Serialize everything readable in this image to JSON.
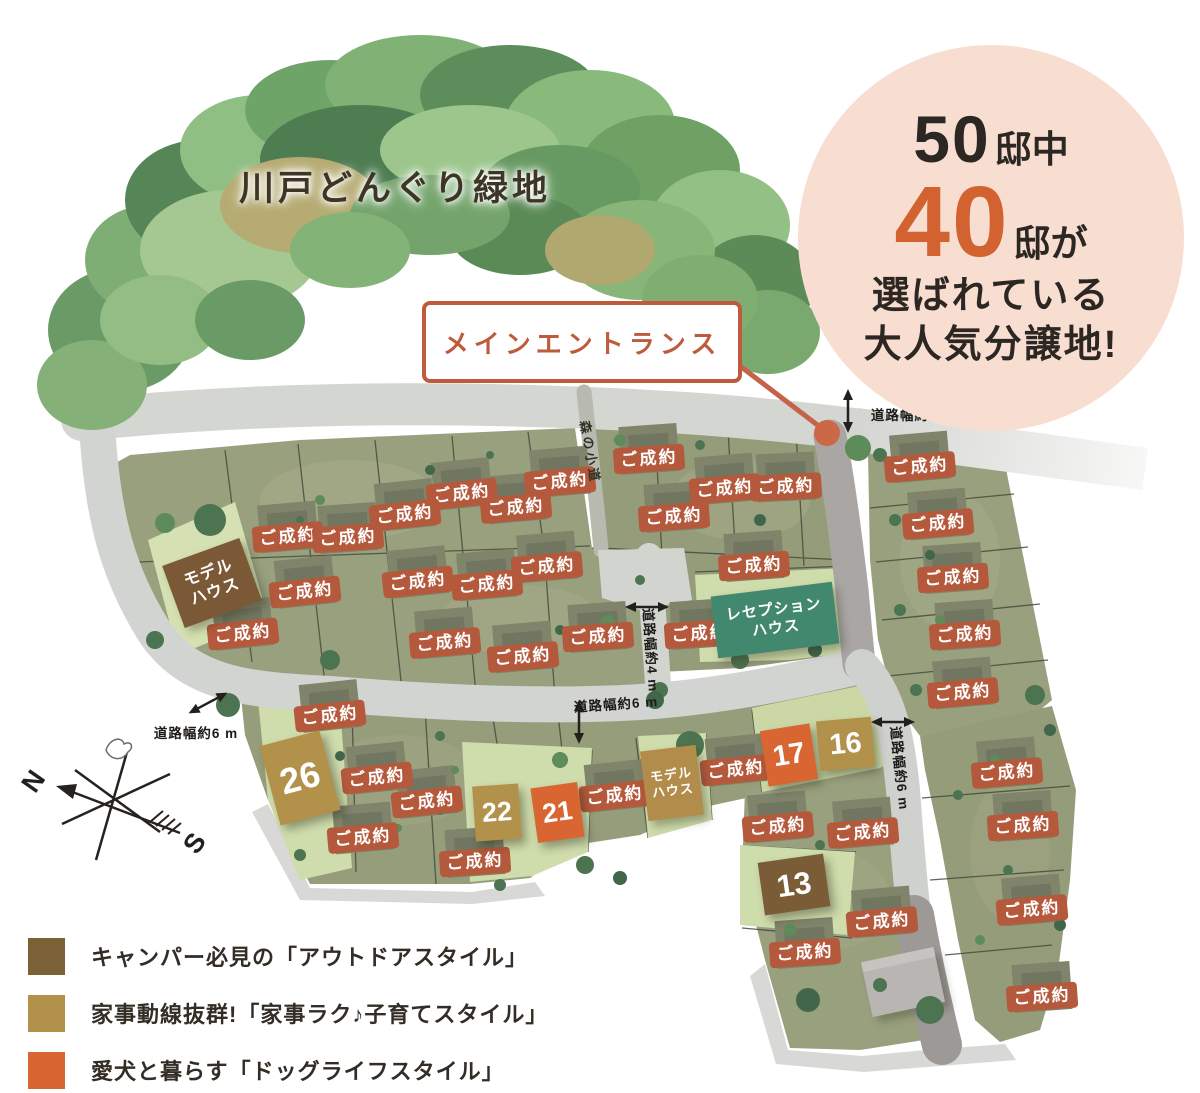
{
  "forest": {
    "title": "川戸どんぐり緑地"
  },
  "badge": {
    "top_num": "50",
    "top_suffix": "邸中",
    "mid_num": "40",
    "mid_suffix": "邸が",
    "line3": "選ばれている",
    "line4": "大人気分譲地!"
  },
  "entrance_label": "メインエントランス",
  "sold_label": "ご成約",
  "sold_lots": [
    [
      649,
      459,
      -4
    ],
    [
      560,
      482,
      -5
    ],
    [
      462,
      494,
      -6
    ],
    [
      725,
      489,
      -5
    ],
    [
      786,
      487,
      -3
    ],
    [
      516,
      508,
      -5
    ],
    [
      674,
      517,
      -4
    ],
    [
      405,
      515,
      -6
    ],
    [
      288,
      537,
      -5
    ],
    [
      348,
      538,
      -4
    ],
    [
      920,
      467,
      -5
    ],
    [
      547,
      567,
      -5
    ],
    [
      754,
      566,
      -4
    ],
    [
      418,
      582,
      -6
    ],
    [
      487,
      585,
      -5
    ],
    [
      305,
      592,
      -6
    ],
    [
      938,
      524,
      -5
    ],
    [
      953,
      578,
      -4
    ],
    [
      243,
      634,
      -6
    ],
    [
      445,
      643,
      -5
    ],
    [
      523,
      657,
      -5
    ],
    [
      598,
      637,
      -4
    ],
    [
      700,
      634,
      -4
    ],
    [
      965,
      635,
      -4
    ],
    [
      963,
      693,
      -5
    ],
    [
      330,
      716,
      -6
    ],
    [
      377,
      778,
      -6
    ],
    [
      427,
      802,
      -6
    ],
    [
      363,
      838,
      -5
    ],
    [
      475,
      862,
      -4
    ],
    [
      615,
      796,
      -6
    ],
    [
      736,
      770,
      -6
    ],
    [
      1007,
      773,
      -5
    ],
    [
      778,
      827,
      -5
    ],
    [
      863,
      833,
      -5
    ],
    [
      1023,
      826,
      -4
    ],
    [
      882,
      922,
      -5
    ],
    [
      805,
      953,
      -4
    ],
    [
      1032,
      910,
      -5
    ],
    [
      1042,
      997,
      -4
    ]
  ],
  "numbered_lots": [
    {
      "num": "26",
      "x": 300,
      "y": 778,
      "w": 62,
      "h": 82,
      "rot": -15,
      "style": "kaji"
    },
    {
      "num": "22",
      "x": 497,
      "y": 812,
      "w": 46,
      "h": 55,
      "rot": -4,
      "style": "kaji"
    },
    {
      "num": "21",
      "x": 557,
      "y": 812,
      "w": 47,
      "h": 55,
      "rot": -8,
      "style": "dog"
    },
    {
      "num": "17",
      "x": 789,
      "y": 755,
      "w": 50,
      "h": 56,
      "rot": -9,
      "style": "dog"
    },
    {
      "num": "16",
      "x": 845,
      "y": 744,
      "w": 55,
      "h": 50,
      "rot": -5,
      "style": "kaji"
    },
    {
      "num": "13",
      "x": 794,
      "y": 884,
      "w": 66,
      "h": 53,
      "rot": -8,
      "style": "outdoor"
    }
  ],
  "style_colors": {
    "outdoor": "#7a5c36",
    "kaji": "#b2914b",
    "dog": "#d96632"
  },
  "buildings": [
    {
      "id": "model-house-left",
      "line1": "モデル",
      "line2": "ハウス",
      "x": 212,
      "y": 583,
      "w": 82,
      "h": 66,
      "rot": -20,
      "bg": "#7b5836",
      "font": 16
    },
    {
      "id": "model-house-bottom",
      "line1": "モデル",
      "line2": "ハウス",
      "x": 672,
      "y": 783,
      "w": 56,
      "h": 70,
      "rot": -7,
      "bg": "#b28c4a",
      "font": 13
    },
    {
      "id": "reception-house",
      "line1": "レセプション",
      "line2": "ハウス",
      "x": 775,
      "y": 620,
      "w": 122,
      "h": 62,
      "rot": -7,
      "bg": "#41886f",
      "font": 15
    }
  ],
  "road_labels": [
    {
      "text": "道路幅約6 m",
      "x": 913,
      "y": 414,
      "rot": 0,
      "arrow": "v",
      "ax": 848,
      "ay": 411
    },
    {
      "text": "道路幅約4 m",
      "x": 652,
      "y": 650,
      "rot": 86,
      "arrow": "h",
      "ax": 647,
      "ay": 607
    },
    {
      "text": "道路幅約6 m",
      "x": 616,
      "y": 703,
      "rot": -4,
      "arrow": "v",
      "ax": 579,
      "ay": 722
    },
    {
      "text": "道路幅約6 m",
      "x": 196,
      "y": 732,
      "rot": 0,
      "arrow": "d",
      "ax": 208,
      "ay": 703
    },
    {
      "text": "道路幅約6 m",
      "x": 901,
      "y": 768,
      "rot": 84,
      "arrow": "h",
      "ax": 893,
      "ay": 722
    }
  ],
  "forest_path_label": {
    "text": "森の小道",
    "x": 591,
    "y": 452,
    "rot": 80
  },
  "compass": {
    "n": "N",
    "s": "S"
  },
  "legend": [
    {
      "color": "#7a6136",
      "prefix": "キャンパー必見の",
      "highlight": "「アウトドアスタイル」"
    },
    {
      "color": "#b2914b",
      "prefix": "家事動線抜群!",
      "highlight": "「家事ラク♪子育てスタイル」"
    },
    {
      "color": "#d96632",
      "prefix": "愛犬と暮らす",
      "highlight": "「ドッグライフスタイル」"
    }
  ]
}
